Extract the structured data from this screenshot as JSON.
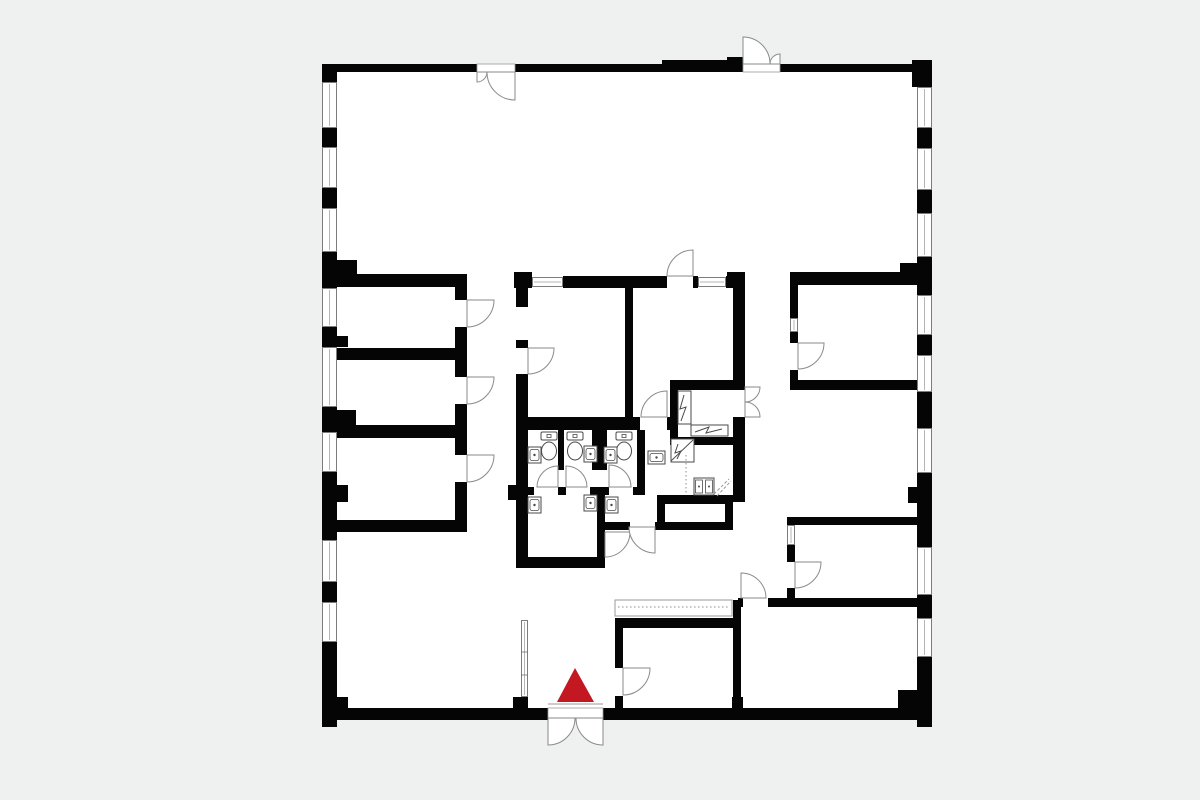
{
  "scene": {
    "width": 1200,
    "height": 800,
    "background_color": "#eff0f0",
    "floor_color": "#ffffff",
    "wall_color": "#050505",
    "door_stroke": "#8a8a8a",
    "fixture_stroke": "#4a4a4a",
    "window_stroke": "#6f6f6f",
    "window_mid": "#b5b5b5",
    "thin_line": "#9a9a9a",
    "marker_color": "#c31722"
  },
  "plan": {
    "floor": {
      "x": 322,
      "y": 64,
      "w": 610,
      "h": 656
    },
    "walls": [
      [
        322,
        64,
        15,
        18
      ],
      [
        337,
        64,
        140,
        8
      ],
      [
        515,
        64,
        147,
        8
      ],
      [
        662,
        60,
        65,
        12
      ],
      [
        727,
        57,
        16,
        15
      ],
      [
        780,
        64,
        132,
        8
      ],
      [
        912,
        60,
        20,
        27
      ],
      [
        322,
        128,
        15,
        19
      ],
      [
        322,
        188,
        15,
        20
      ],
      [
        322,
        252,
        15,
        36
      ],
      [
        322,
        327,
        15,
        20
      ],
      [
        322,
        407,
        15,
        25
      ],
      [
        322,
        472,
        15,
        68
      ],
      [
        322,
        582,
        15,
        20
      ],
      [
        322,
        642,
        15,
        85
      ],
      [
        322,
        700,
        15,
        27
      ],
      [
        337,
        260,
        20,
        15
      ],
      [
        337,
        336,
        11,
        11
      ],
      [
        337,
        410,
        19,
        16
      ],
      [
        337,
        485,
        11,
        17
      ],
      [
        917,
        60,
        15,
        27
      ],
      [
        917,
        128,
        15,
        20
      ],
      [
        917,
        190,
        15,
        23
      ],
      [
        917,
        257,
        15,
        38
      ],
      [
        917,
        335,
        15,
        20
      ],
      [
        917,
        392,
        15,
        36
      ],
      [
        917,
        473,
        15,
        74
      ],
      [
        917,
        595,
        15,
        23
      ],
      [
        917,
        657,
        15,
        70
      ],
      [
        900,
        263,
        17,
        20
      ],
      [
        908,
        487,
        9,
        16
      ],
      [
        898,
        690,
        19,
        18
      ],
      [
        322,
        708,
        226,
        12
      ],
      [
        603,
        708,
        329,
        12
      ],
      [
        333,
        697,
        15,
        11
      ],
      [
        513,
        697,
        15,
        11
      ],
      [
        732,
        697,
        11,
        11
      ],
      [
        912,
        700,
        20,
        18
      ],
      [
        337,
        274,
        130,
        13
      ],
      [
        337,
        348,
        130,
        12
      ],
      [
        337,
        425,
        130,
        13
      ],
      [
        337,
        520,
        130,
        12
      ],
      [
        455,
        274,
        12,
        26
      ],
      [
        455,
        327,
        12,
        50
      ],
      [
        455,
        404,
        12,
        51
      ],
      [
        455,
        482,
        12,
        50
      ],
      [
        514,
        272,
        18,
        16
      ],
      [
        563,
        276,
        104,
        12
      ],
      [
        693,
        276,
        5,
        12
      ],
      [
        726,
        276,
        19,
        12
      ],
      [
        727,
        272,
        18,
        16
      ],
      [
        516,
        288,
        12,
        19
      ],
      [
        516,
        340,
        12,
        8
      ],
      [
        516,
        374,
        12,
        194
      ],
      [
        508,
        485,
        20,
        15
      ],
      [
        625,
        288,
        8,
        132
      ],
      [
        516,
        417,
        124,
        13
      ],
      [
        667,
        417,
        11,
        13
      ],
      [
        670,
        380,
        8,
        65
      ],
      [
        678,
        380,
        67,
        10
      ],
      [
        670,
        437,
        75,
        8
      ],
      [
        733,
        288,
        12,
        99
      ],
      [
        733,
        417,
        12,
        85
      ],
      [
        558,
        430,
        6,
        40
      ],
      [
        592,
        430,
        12,
        40
      ],
      [
        602,
        430,
        5,
        40
      ],
      [
        637,
        430,
        8,
        60
      ],
      [
        516,
        487,
        18,
        8
      ],
      [
        558,
        487,
        8,
        8
      ],
      [
        590,
        487,
        19,
        8
      ],
      [
        633,
        487,
        12,
        8
      ],
      [
        597,
        487,
        8,
        81
      ],
      [
        516,
        557,
        87,
        11
      ],
      [
        657,
        495,
        76,
        9
      ],
      [
        657,
        495,
        8,
        35
      ],
      [
        725,
        495,
        8,
        35
      ],
      [
        605,
        522,
        25,
        8
      ],
      [
        655,
        522,
        78,
        8
      ],
      [
        733,
        488,
        12,
        14
      ],
      [
        790,
        272,
        127,
        13
      ],
      [
        790,
        285,
        8,
        33
      ],
      [
        790,
        332,
        8,
        11
      ],
      [
        790,
        370,
        8,
        18
      ],
      [
        790,
        380,
        127,
        10
      ],
      [
        787,
        517,
        130,
        8
      ],
      [
        787,
        545,
        8,
        17
      ],
      [
        787,
        588,
        8,
        19
      ],
      [
        738,
        598,
        5,
        9
      ],
      [
        768,
        598,
        149,
        9
      ],
      [
        733,
        600,
        8,
        108
      ],
      [
        615,
        618,
        8,
        50
      ],
      [
        615,
        696,
        8,
        12
      ],
      [
        618,
        618,
        115,
        10
      ]
    ],
    "windows": [
      {
        "x": 322,
        "y": 82,
        "w": 15,
        "h": 46,
        "o": "v"
      },
      {
        "x": 322,
        "y": 147,
        "w": 15,
        "h": 41,
        "o": "v"
      },
      {
        "x": 322,
        "y": 208,
        "w": 15,
        "h": 44,
        "o": "v"
      },
      {
        "x": 322,
        "y": 288,
        "w": 15,
        "h": 39,
        "o": "v"
      },
      {
        "x": 322,
        "y": 347,
        "w": 15,
        "h": 60,
        "o": "v"
      },
      {
        "x": 322,
        "y": 432,
        "w": 15,
        "h": 40,
        "o": "v"
      },
      {
        "x": 322,
        "y": 540,
        "w": 15,
        "h": 42,
        "o": "v"
      },
      {
        "x": 322,
        "y": 602,
        "w": 15,
        "h": 40,
        "o": "v"
      },
      {
        "x": 917,
        "y": 87,
        "w": 15,
        "h": 41,
        "o": "v"
      },
      {
        "x": 917,
        "y": 148,
        "w": 15,
        "h": 42,
        "o": "v"
      },
      {
        "x": 917,
        "y": 213,
        "w": 15,
        "h": 44,
        "o": "v"
      },
      {
        "x": 917,
        "y": 295,
        "w": 15,
        "h": 40,
        "o": "v"
      },
      {
        "x": 917,
        "y": 355,
        "w": 15,
        "h": 37,
        "o": "v"
      },
      {
        "x": 917,
        "y": 428,
        "w": 15,
        "h": 45,
        "o": "v"
      },
      {
        "x": 917,
        "y": 547,
        "w": 15,
        "h": 48,
        "o": "v"
      },
      {
        "x": 917,
        "y": 618,
        "w": 15,
        "h": 39,
        "o": "v"
      },
      {
        "x": 532,
        "y": 277,
        "w": 31,
        "h": 10,
        "o": "h"
      },
      {
        "x": 698,
        "y": 277,
        "w": 28,
        "h": 10,
        "o": "h"
      },
      {
        "x": 790,
        "y": 318,
        "w": 8,
        "h": 14,
        "o": "v"
      },
      {
        "x": 787,
        "y": 525,
        "w": 8,
        "h": 20,
        "o": "v"
      },
      {
        "x": 521,
        "y": 620,
        "w": 7,
        "h": 77,
        "o": "v",
        "ticks": [
          652,
          675
        ]
      }
    ],
    "sills": [
      [
        477,
        64,
        38,
        8
      ],
      [
        743,
        62,
        37,
        10
      ],
      [
        548,
        708,
        55,
        12
      ]
    ],
    "threshold": [
      548,
      704,
      603,
      704
    ],
    "doors": [
      [
        477,
        72,
        10,
        0,
        90
      ],
      [
        515,
        72,
        28,
        90,
        180
      ],
      [
        743,
        64,
        27,
        270,
        360
      ],
      [
        780,
        64,
        10,
        180,
        270
      ],
      [
        693,
        276,
        26,
        180,
        270
      ],
      [
        528,
        348,
        26,
        0,
        90
      ],
      [
        467,
        300,
        27,
        0,
        90
      ],
      [
        467,
        377,
        27,
        0,
        90
      ],
      [
        467,
        455,
        27,
        0,
        90
      ],
      [
        798,
        343,
        26,
        0,
        90
      ],
      [
        795,
        562,
        26,
        0,
        90
      ],
      [
        667,
        417,
        26,
        180,
        270
      ],
      [
        745,
        387,
        15,
        0,
        90
      ],
      [
        745,
        417,
        15,
        270,
        360
      ],
      [
        558,
        487,
        21,
        180,
        270
      ],
      [
        566,
        487,
        21,
        270,
        360
      ],
      [
        609,
        487,
        22,
        270,
        360
      ],
      [
        605,
        532,
        25,
        0,
        90
      ],
      [
        655,
        527,
        26,
        90,
        180
      ],
      [
        623,
        668,
        27,
        0,
        90
      ],
      [
        741,
        598,
        25,
        270,
        360
      ],
      [
        548,
        718,
        27,
        0,
        90
      ],
      [
        603,
        718,
        27,
        90,
        180
      ]
    ],
    "toilets": [
      [
        549,
        432
      ],
      [
        575,
        432
      ],
      [
        624,
        432
      ]
    ],
    "sinks": [
      {
        "x": 528,
        "y": 447,
        "w": 13,
        "h": 16
      },
      {
        "x": 584,
        "y": 446,
        "w": 13,
        "h": 16
      },
      {
        "x": 604,
        "y": 447,
        "w": 13,
        "h": 16
      },
      {
        "x": 528,
        "y": 497,
        "w": 13,
        "h": 16
      },
      {
        "x": 584,
        "y": 495,
        "w": 13,
        "h": 16
      },
      {
        "x": 605,
        "y": 497,
        "w": 13,
        "h": 16
      },
      {
        "x": 648,
        "y": 451,
        "w": 17,
        "h": 13
      }
    ],
    "kitchen_sink": {
      "x": 694,
      "y": 478,
      "w": 20,
      "h": 17
    },
    "utility_boxes": [
      {
        "rect": [
          678,
          391,
          13,
          33
        ],
        "zig": "684,395 680,409 686,407 681,421"
      },
      {
        "rect": [
          691,
          425,
          37,
          11
        ],
        "zig": "695,432 709,427 706,433 722,429"
      },
      {
        "rect": [
          671,
          439,
          23,
          23
        ],
        "zig": "678,444 675,453 681,451 677,459",
        "diag": [
          671,
          461,
          693,
          440
        ]
      }
    ],
    "dotted_lines": [
      [
        686,
        455,
        686,
        494
      ]
    ],
    "diag_lines": [
      [
        714,
        494,
        729,
        479
      ],
      [
        717,
        496,
        731,
        481
      ]
    ],
    "counter": {
      "x": 615,
      "y": 600,
      "w": 117,
      "h": 16,
      "dotted_y": 607
    },
    "marker": {
      "points": [
        [
          575,
          668
        ],
        [
          557,
          702
        ],
        [
          594,
          702
        ]
      ]
    }
  }
}
